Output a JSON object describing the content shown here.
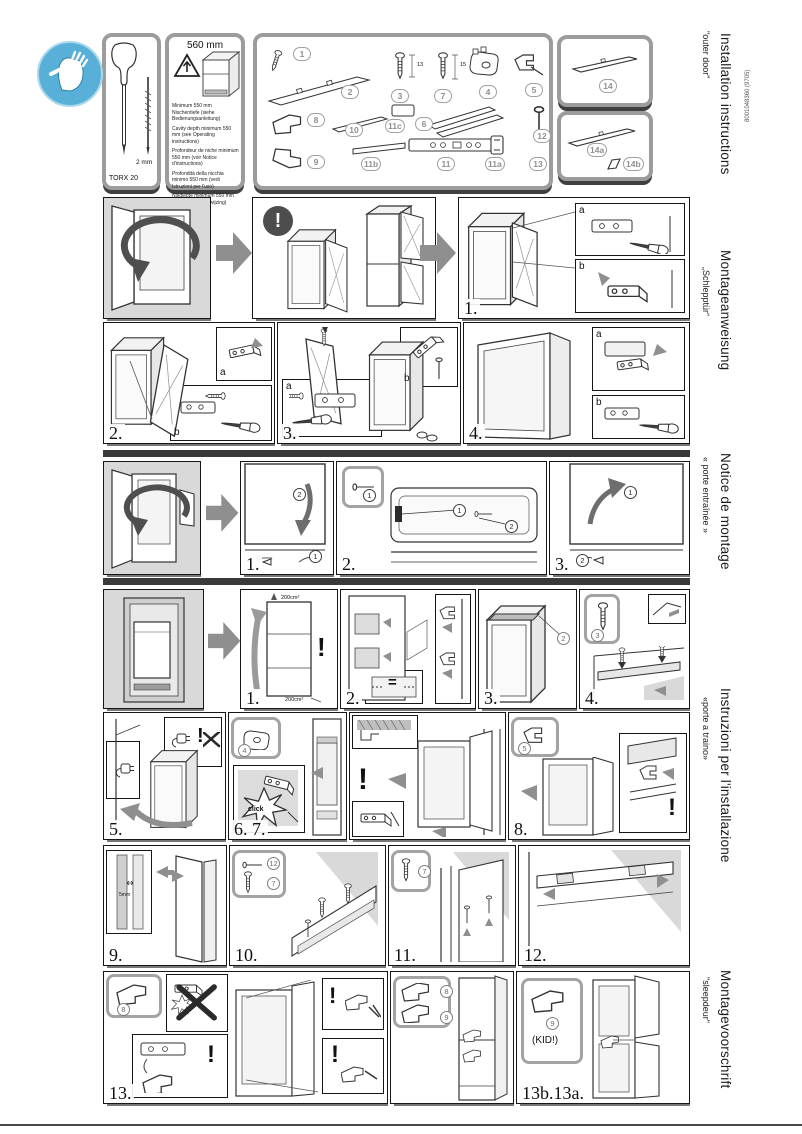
{
  "doc_number": "8001048360 (9705)",
  "sections": [
    {
      "title": "Installation instructions",
      "subtitle": "\"outer door\""
    },
    {
      "title": "Montageanweisung",
      "subtitle": "„Schlepptür“"
    },
    {
      "title": "Notice de montage",
      "subtitle": "« porte entraînée »"
    },
    {
      "title": "Instruzioni per l'installazione",
      "subtitle": "«porte a traino»"
    },
    {
      "title": "Montagevoorschrift",
      "subtitle": "\"sleepdeur\""
    }
  ],
  "tools_panel": {
    "screwdriver_label": "TORX 20",
    "bit_label": "2 mm"
  },
  "cavity_panel": {
    "dimension": "560 mm",
    "notes": [
      "Minimum 550 mm Nischentiefe (siehe Bedienungsanleitung)",
      "Cavity depth minimum 550 mm (see Operating instructions)",
      "Profondeur de niche minimum 550 mm (voir Notice d'instructions)",
      "Profondità della nicchia minimo 550 mm (vedi Istruzioni per l'uso)",
      "Nisdiepte minimum 550 mm (zie Gebruiksaanwijzing)"
    ]
  },
  "parts": {
    "b1": "1",
    "b2": "2",
    "b3": "3",
    "b7": "7",
    "b4": "4",
    "b5": "5",
    "b8": "8",
    "b10": "10",
    "b11c": "11c",
    "b6": "6",
    "b12": "12",
    "b9": "9",
    "b11b": "11b",
    "b11": "11",
    "b11a": "11a",
    "b13": "13",
    "b14": "14",
    "b14a": "14a",
    "b14b": "14b",
    "dim13": "13",
    "dim15": "15"
  },
  "steps": {
    "s1": "1.",
    "s2": "2.",
    "s3": "3.",
    "s4": "4.",
    "f1": "1.",
    "f2": "2.",
    "f3": "3.",
    "n1": "1.",
    "n2": "2.",
    "n3": "3.",
    "n4": "4.",
    "s5": "5.",
    "s67": "6. 7.",
    "s8": "8.",
    "s9": "9.",
    "s10": "10.",
    "s11": "11.",
    "s12": "12.",
    "s13": "13.",
    "s13b": "13b.13a."
  },
  "ann": {
    "exclaim": "!",
    "click": "click",
    "kid": "(KID!)",
    "gap": "5mm",
    "vent": "200cm²",
    "equals": "=",
    "a": "a",
    "b": "b",
    "c1": "1",
    "c2": "2",
    "c3": "3",
    "c4": "4",
    "c5": "5",
    "c7": "7",
    "c8": "8",
    "c9": "9",
    "c12": "12"
  }
}
